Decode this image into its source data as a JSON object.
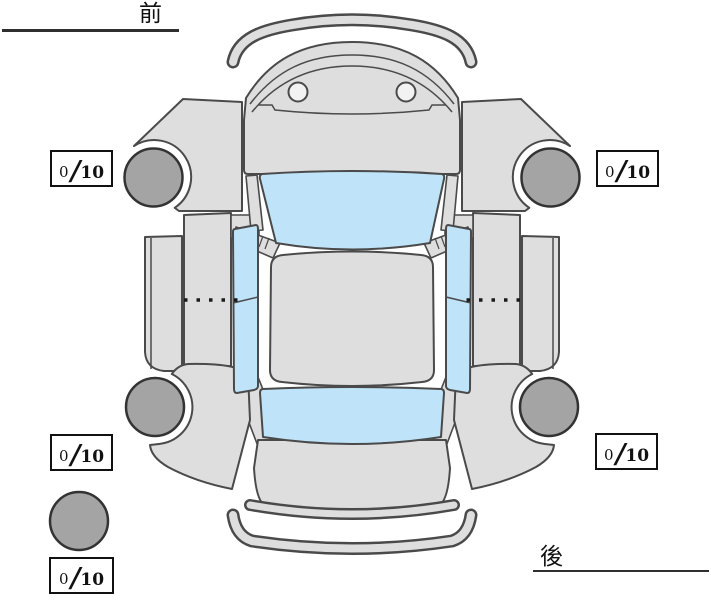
{
  "labels": {
    "front": "前",
    "rear": "後"
  },
  "ratings": {
    "front_left": {
      "value": "0",
      "separator": "/",
      "max": "10"
    },
    "front_right": {
      "value": "0",
      "separator": "/",
      "max": "10"
    },
    "rear_left": {
      "value": "0",
      "separator": "/",
      "max": "10"
    },
    "rear_right": {
      "value": "0",
      "separator": "/",
      "max": "10"
    },
    "spare": {
      "value": "0",
      "separator": "/",
      "max": "10"
    }
  },
  "diagram": {
    "view": "car-top-view-tire-condition",
    "colors": {
      "bg": "#ffffff",
      "body": "#dedede",
      "outline": "#4a4a4a",
      "tire": "#a4a4a4",
      "window": "#bfe3f8",
      "boxBorder": "#111111"
    }
  }
}
